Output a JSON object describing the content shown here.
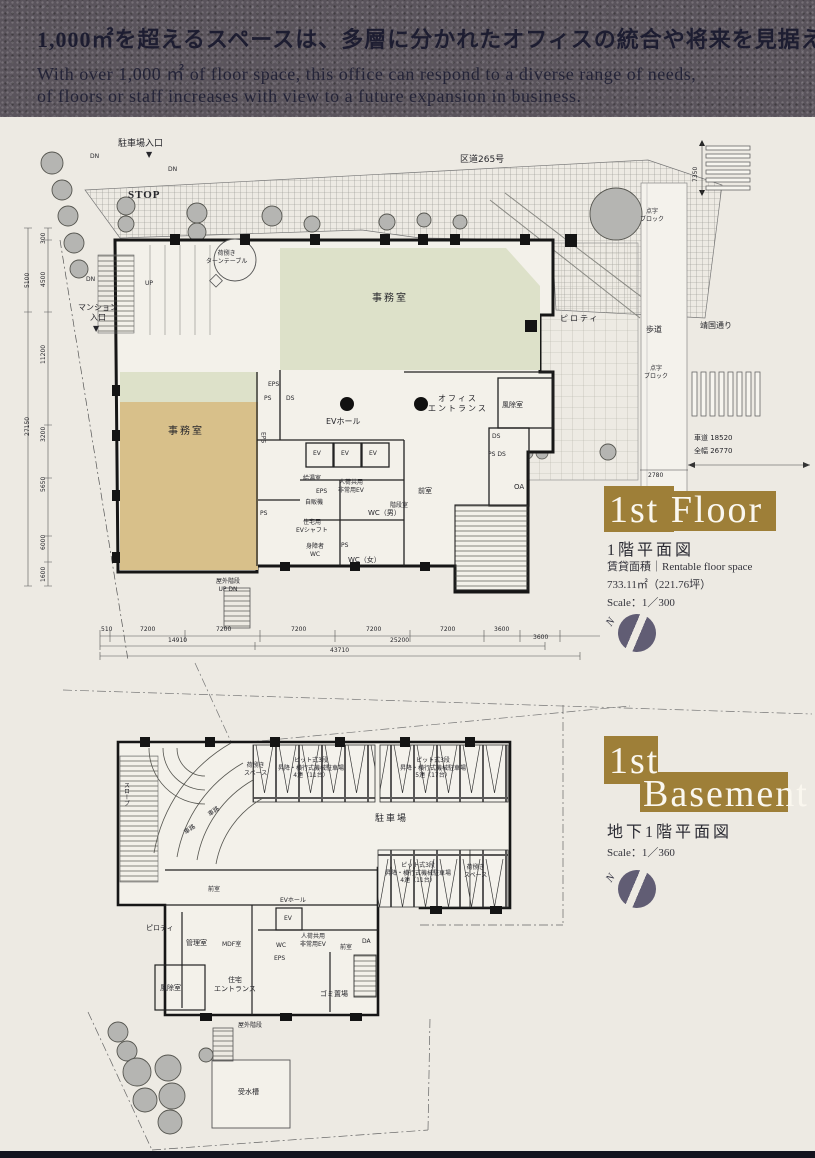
{
  "header": {
    "headline_jp": "1,000㎡を超えるスペースは、多層に分かれたオフィスの統合や将来を見据えた",
    "subline_en_1": "With over 1,000 ㎡ of floor space, this office can respond to a diverse range of needs,",
    "subline_en_2": "of floors or staff increases with view to a future expansion in business."
  },
  "floor1": {
    "title_en": "1st Floor",
    "title_jp": "1階平面図",
    "area_label": "賃貸面積｜Rentable floor space",
    "area_value": "733.11㎡（221.76坪）",
    "scale": "Scale：1／300",
    "north": "N",
    "site": {
      "parking_entrance": "駐車場入口",
      "mansion_entrance": "マンション\n入口",
      "stop": "STOP",
      "ward_road": "区道265号",
      "sidewalk": "歩道",
      "yasukuni_street": "靖国通り",
      "braille_block": "点字\nブロック",
      "roadway": "車道 18520",
      "full_width": "全幅 26770",
      "turntable": "荷捌き\nターンテーブル",
      "piloti": "ピロティ"
    },
    "rooms": {
      "office": "事務室",
      "ev_hall": "EVホール",
      "office_entrance": "オフィス\nエントランス",
      "windbreak": "風除室",
      "anteroom": "前室",
      "stairwell": "階段室",
      "wc_men": "WC（男）",
      "wc_women": "WC（女）",
      "wc_handicap": "身障者\nWC",
      "res_ev_shaft": "住宅用\nEVシャフト",
      "kitchenette": "給湯室",
      "vending": "自販機",
      "service_ev": "人荷共用\n非常用EV",
      "outdoor_stair": "屋外階段\nUP DN"
    },
    "shafts": {
      "eps": "EPS",
      "ps": "PS",
      "ds": "DS",
      "oa": "OA",
      "ps_ds": "PS DS",
      "ev": "EV"
    },
    "marks": {
      "dn": "DN",
      "up": "UP",
      "arrow_down": "▼"
    },
    "dims": {
      "left": [
        "300",
        "4500",
        "5100",
        "11200",
        "3200",
        "5650",
        "6000",
        "1600",
        "27150"
      ],
      "bottom": [
        "510",
        "7200",
        "7200",
        "7200",
        "7200",
        "7200",
        "3600",
        "3600",
        "14910",
        "25200",
        "43710"
      ],
      "road": [
        "2780",
        "7350"
      ]
    }
  },
  "basement": {
    "title_en_1": "1st",
    "title_en_2": "Basement",
    "title_jp": "地下1階平面図",
    "scale": "Scale：1／360",
    "north": "N",
    "rooms": {
      "loading_space": "荷捌き\nスペース",
      "parking": "駐車場",
      "pit_a": "ピット式3段\n昇降・横行式機械駐車場\n4連（11台）",
      "pit_b": "ピット式3段\n昇降・横行式機械駐車場\n5連（17台）",
      "ramp": "車路",
      "slope": "スロープ",
      "ev_hall": "EVホール",
      "ev": "EV",
      "anteroom": "前室",
      "piloti": "ピロティ",
      "manager": "管理室",
      "mdf": "MDF室",
      "wc": "WC",
      "eps": "EPS",
      "da": "DA",
      "service_ev": "人荷共用\n非常用EV",
      "windbreak": "風除室",
      "res_entrance": "住宅\nエントランス",
      "garbage": "ゴミ置場",
      "water_tank": "受水槽",
      "outdoor_stair": "屋外階段"
    }
  },
  "colors": {
    "gold_accent": "#9e7f38",
    "north_circle": "#615d74",
    "office_green": "#dde1c9",
    "office_tan": "#d8c08a",
    "banner_bg": "#5a545c",
    "paper": "#edeae3",
    "footer_bar": "#14141f"
  }
}
